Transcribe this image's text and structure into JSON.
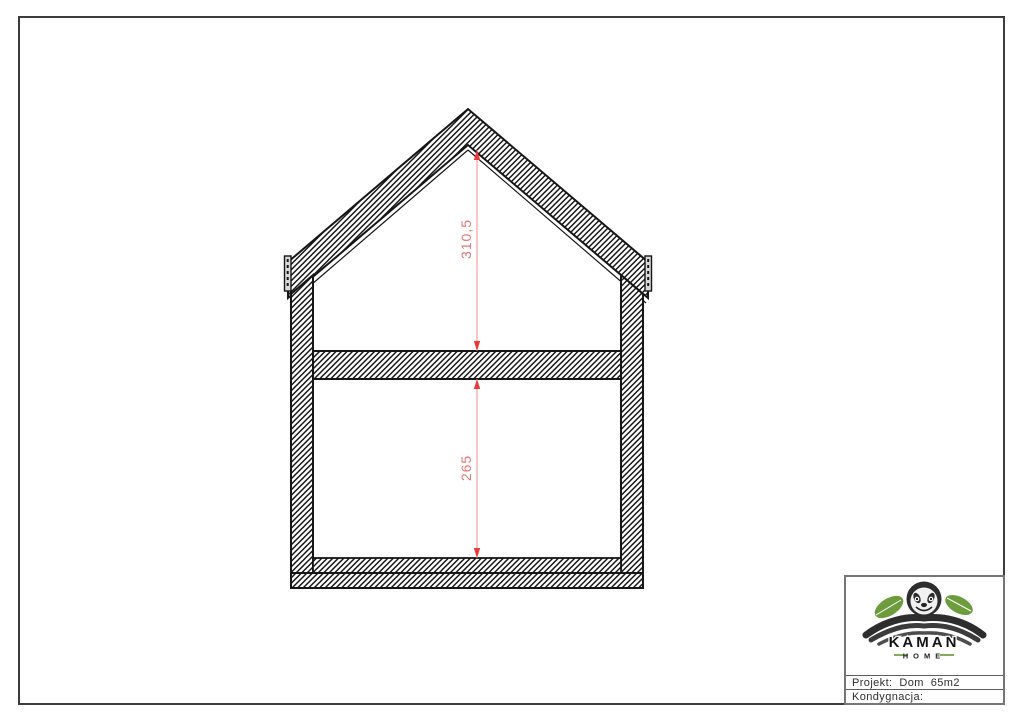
{
  "sheet": {
    "background": "#ffffff",
    "border_color": "#3c3c3c"
  },
  "drawing": {
    "line_color": "#161616",
    "dimension_text_color": "#e57373",
    "dimension_line_color": "#ef8f8f",
    "dimension_arrow_color": "#e83a3a",
    "dimensions": [
      {
        "label": "310,5"
      },
      {
        "label": "265"
      }
    ]
  },
  "title_block": {
    "logo": {
      "brand": "KAMAN",
      "subtitle": "HOME",
      "icon": "sloth-icon",
      "leaf_color": "#6d9c3d"
    },
    "rows": [
      {
        "text": "Projekt:  Dom  65m2"
      },
      {
        "text": "Kondygnacja:"
      }
    ]
  }
}
